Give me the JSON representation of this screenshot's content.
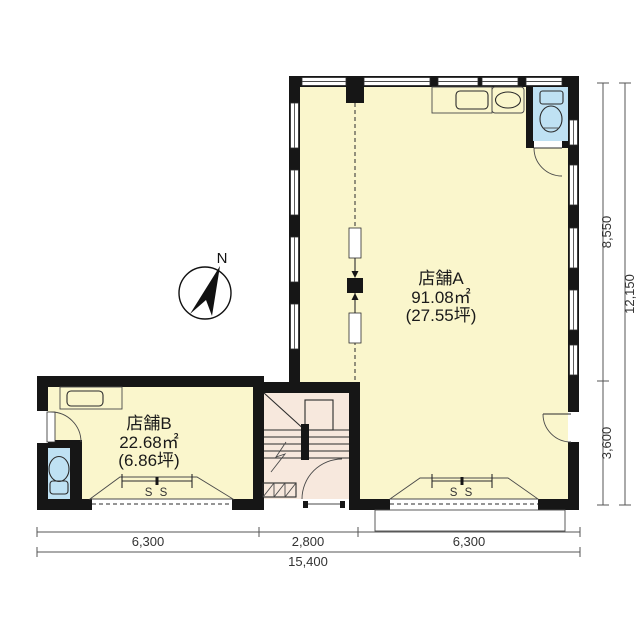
{
  "floorplan": {
    "compass": {
      "label": "N"
    },
    "unit_a": {
      "name": "店舗A",
      "area": "91.08㎡",
      "tsubo": "(27.55坪)",
      "shutter_label": "S S"
    },
    "unit_b": {
      "name": "店舗B",
      "area": "22.68㎡",
      "tsubo": "(6.86坪)",
      "shutter_label": "S S"
    },
    "dims": {
      "right_upper": "8,550",
      "right_lower": "3,600",
      "right_total": "12,150",
      "bottom_left": "6,300",
      "bottom_center": "2,800",
      "bottom_right": "6,300",
      "bottom_total": "15,400"
    },
    "colors": {
      "room": "#FAF6CC",
      "entry": "#F7E8DD",
      "fixture": "#BFE1F3",
      "wall": "#161616",
      "background": "#FFFFFF"
    }
  }
}
